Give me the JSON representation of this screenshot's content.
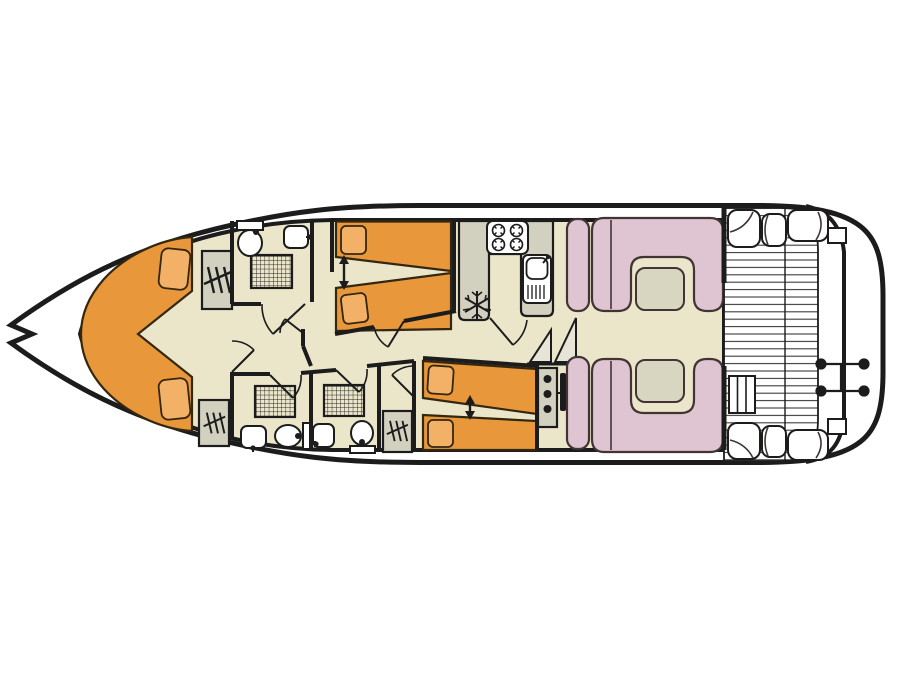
{
  "diagram": {
    "type": "houseboat-deck-plan-top-view",
    "orientation": "bow-left-stern-right",
    "areas": [
      {
        "name": "bow-v-berth-cabin",
        "furniture": [
          "v-shaped-double-berth",
          "pillow",
          "pillow",
          "wardrobe",
          "wardrobe"
        ]
      },
      {
        "name": "forward-bathroom",
        "furniture": [
          "toilet",
          "washbasin",
          "shower"
        ]
      },
      {
        "name": "twin-cabin-forward",
        "furniture": [
          "single-bed",
          "single-bed",
          "slide-together-arrow"
        ]
      },
      {
        "name": "galley",
        "furniture": [
          "four-burner-hob",
          "sink-with-drainer",
          "refrigerator",
          "worktop"
        ]
      },
      {
        "name": "bathroom-aft-port",
        "furniture": [
          "shower",
          "washbasin",
          "toilet"
        ]
      },
      {
        "name": "bathroom-aft-starboard",
        "furniture": [
          "shower",
          "washbasin",
          "toilet",
          "wardrobe"
        ]
      },
      {
        "name": "twin-cabin-aft",
        "furniture": [
          "single-bed",
          "single-bed",
          "slide-together-arrow"
        ]
      },
      {
        "name": "saloon-dinette",
        "furniture": [
          "u-shaped-sofa",
          "u-shaped-sofa",
          "table",
          "table",
          "side-seat",
          "side-seat"
        ]
      },
      {
        "name": "helm",
        "furniture": [
          "console-with-gauges",
          "steering-wheel",
          "companionway-steps"
        ]
      },
      {
        "name": "aft-deck",
        "furniture": [
          "plank-decking",
          "corner-bench",
          "corner-bench",
          "boarding-ladder",
          "rudder-linkage",
          "swim-platform"
        ]
      }
    ],
    "counts": {
      "single_beds": 4,
      "double_berths": 1,
      "bathrooms": 3,
      "showers": 3,
      "toilets": 3,
      "washbasins": 3,
      "wardrobes": 3,
      "dinette_tables": 2
    },
    "icons": [
      "hanger-icon",
      "snowflake-fridge-icon",
      "shower-grid-icon",
      "hob-burner-icon",
      "double-arrow-icon",
      "door-swing-arc",
      "deck-plank-hatching",
      "gauge-dots"
    ]
  },
  "colors": {
    "outline": "#1c1c1c",
    "hull_white": "#ffffff",
    "interior_beige": "#ebe6ca",
    "bed_orange": "#e8973b",
    "pillow_orange": "#f2b166",
    "seat_pink": "#dfc5d1",
    "table_green": "#d8d6c0",
    "counter_grey": "#d2d1c0",
    "stair_fill": "#e6e5d8",
    "deck_line": "#3a3a3a"
  }
}
